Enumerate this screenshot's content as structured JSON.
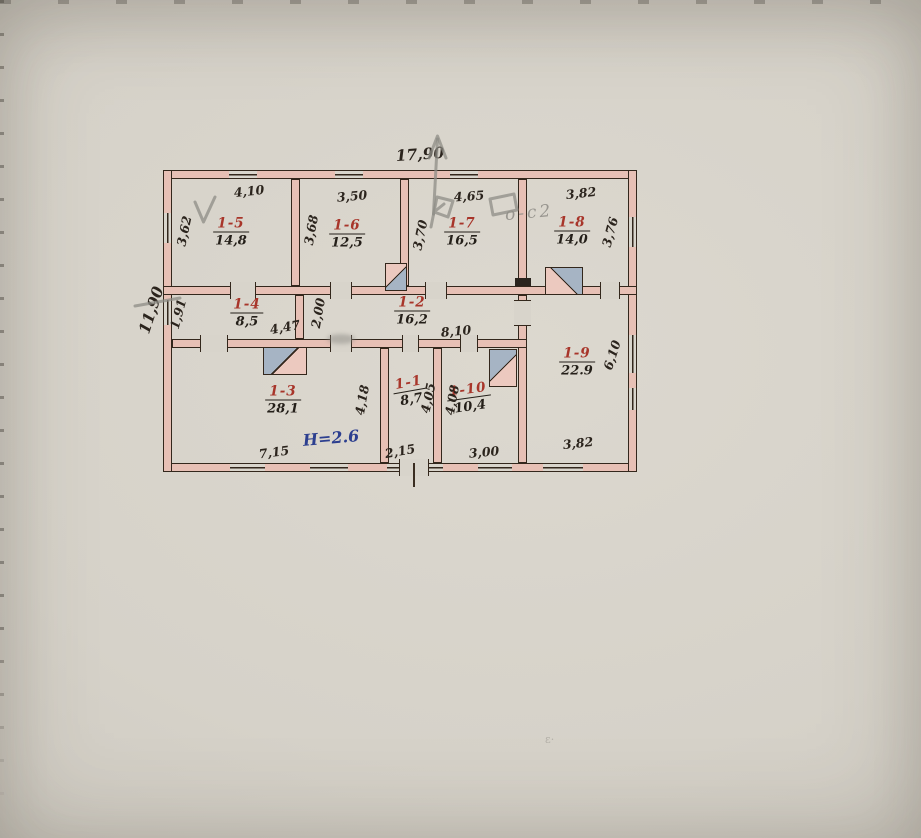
{
  "document": {
    "type": "scanned hand-drawn floor plan",
    "overall": {
      "width": "17,90",
      "height": "11,90",
      "ceiling_height_note": "Н=2.6"
    },
    "rooms": [
      {
        "id": "1-5",
        "area": "14,8",
        "w": "4,10",
        "h": "3,62"
      },
      {
        "id": "1-6",
        "area": "12,5",
        "w": "3,50",
        "h": "3,68"
      },
      {
        "id": "1-7",
        "area": "16,5",
        "w": "4,65",
        "h": "3,70"
      },
      {
        "id": "1-8",
        "area": "14,0",
        "w": "3,82",
        "h": "3,76"
      },
      {
        "id": "1-4",
        "area": "8,5",
        "w": "4,47",
        "h": "1,91"
      },
      {
        "id": "1-2",
        "area": "16,2",
        "w": "8,10",
        "h": "2,00"
      },
      {
        "id": "1-9",
        "area": "22.9",
        "w": "3,82",
        "h": "6,10"
      },
      {
        "id": "1-3",
        "area": "28,1",
        "w": "7,15",
        "h": "4,18"
      },
      {
        "id": "1-1",
        "area": "8,7",
        "w": "2,15",
        "h": "4,05"
      },
      {
        "id": "1-10",
        "area": "10,4",
        "w": "3,00",
        "h": "4,08"
      }
    ],
    "pencil": {
      "note": "о-с2",
      "stray": "ε·"
    },
    "colors": {
      "paper": "#d6d2c9",
      "ink": "#2b241d",
      "red_ink": "#a8352a",
      "blue_ink": "#2c3f8f",
      "wall_fill": "#e7c0b5",
      "stove_blue": "#a6b4c4",
      "pencil": "#8e8c86"
    }
  }
}
